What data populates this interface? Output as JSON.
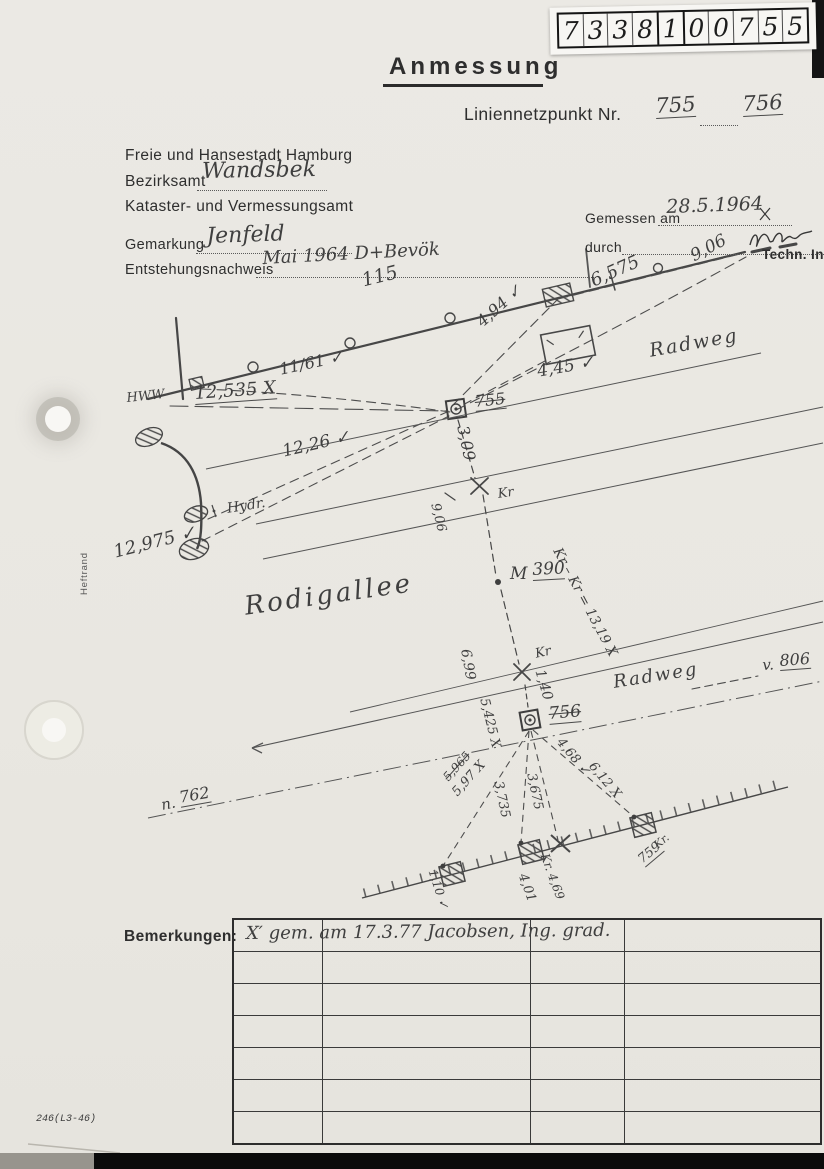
{
  "document": {
    "sticker_digits": [
      "7",
      "3",
      "3",
      "8",
      "1",
      "0",
      "0",
      "7",
      "5",
      "5"
    ],
    "title": "Anmessung",
    "subtitle_label": "Liniennetzpunkt Nr.",
    "point_no_1": "755",
    "point_no_2": "756",
    "header": {
      "line1": "Freie und Hansestadt Hamburg",
      "bezirksamt_label": "Bezirksamt",
      "bezirksamt_value": "Wandsbek",
      "line3": "Kataster- und Vermessungsamt",
      "gemarkung_label": "Gemarkung",
      "gemarkung_value": "Jenfeld",
      "entstehung_label": "Entstehungsnachweis",
      "entstehung_value": "Mai 1964 D+Bevök",
      "gemessen_label": "Gemessen am",
      "gemessen_value": "28.5.1964",
      "durch_label": "durch",
      "stamp": "Techn. In"
    },
    "margin_note": "Heftrand",
    "form_number": "246(L3-46)",
    "bemerkungen": {
      "label": "Bemerkungen:",
      "row1": "X′ gem. am 17.3.77  Jacobsen, Ing. grad."
    }
  },
  "sketch": {
    "street_name": "Rodigallee",
    "labels": {
      "len_115": "115",
      "ratio_11_61": "11/61 ✓",
      "hww": "HWW",
      "m_12_535": "12,535 X",
      "m_4_94": "4,94 ✓",
      "m_6_575": "6,575",
      "m_9_06": "9,06",
      "m_4_45": "4,45 ✓",
      "radweg_top": "Radweg",
      "pt_755": "755",
      "m_3_09": "3,09",
      "kr_top": "Kr",
      "m_9_06b": "9,06",
      "m_label": "M",
      "m_390": "390",
      "kr_kr": "Kr – Kr = 13,19 X",
      "m_12_26": "12,26 ✓",
      "hydr": "Hydr.",
      "m_12_975": "12,975 ✓",
      "m_6_99": "6,99",
      "kr_mid": "Kr",
      "m_1_40": "1,40",
      "radweg_bottom": "Radweg",
      "v_label": "v.",
      "v_806": "806",
      "pt_756": "756",
      "m_5_425": "5,425 X",
      "m_5_965": "5,965",
      "m_5_97": "5,97 X",
      "m_3_735": "3,735",
      "m_3_675": "3,675",
      "m_4_68": "4,68 ✓",
      "m_6_12": "6,12 X",
      "m_1_10": "1,10 ✓",
      "m_4_01": "4,01",
      "kr_4_69": "Kr. 4,69",
      "kr_low": "Kr.",
      "pt_759": "759",
      "n_label": "n.",
      "n_762": "762"
    }
  }
}
